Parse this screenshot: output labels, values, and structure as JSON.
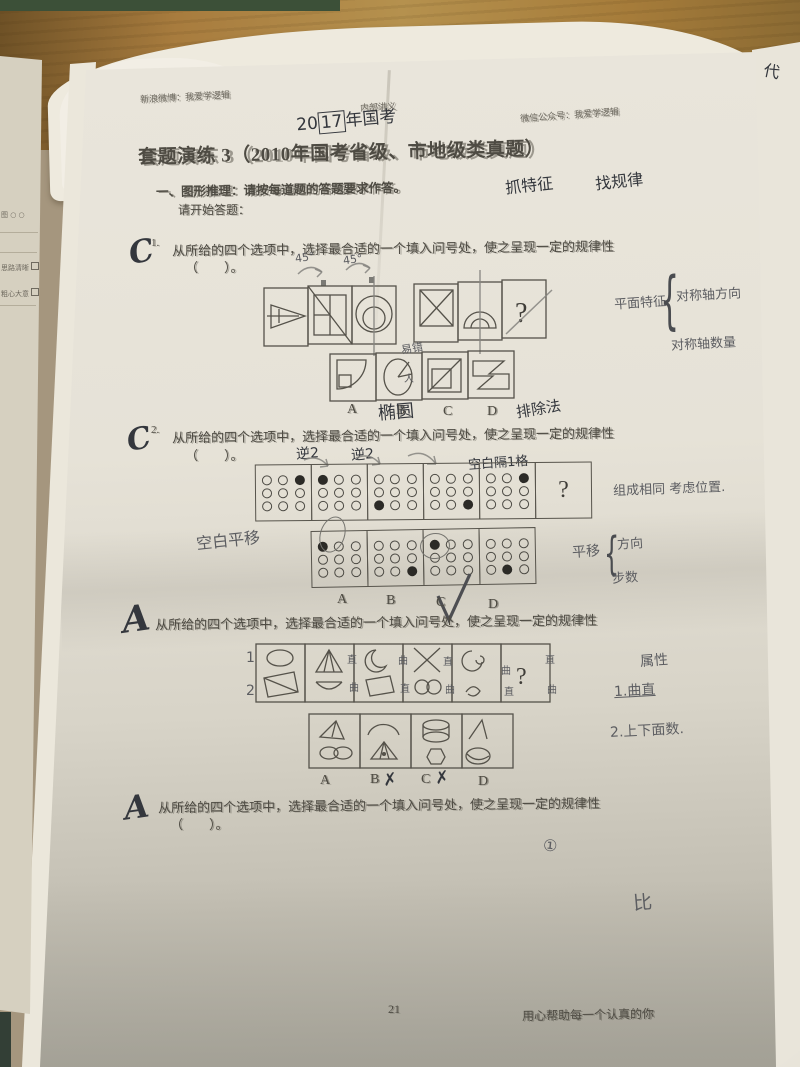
{
  "background": {
    "underlying_print_topright": "…藏的一言一语",
    "underlying_handwriting_topright": "代",
    "left_edge_paper_lines": [
      "图 ○ ○",
      "思路清晰",
      "粗心大意"
    ]
  },
  "header": {
    "watermark_left": "新浪微博：我爱学逻辑",
    "watermark_center": "内部讲义",
    "watermark_right": "微信公众号：我爱学逻辑"
  },
  "title": {
    "printed": "套题演练 3（2010年国考省级、市地级类真题）",
    "handwritten_prefix": "20",
    "handwritten_boxed": "17",
    "handwritten_suffix": "年国考"
  },
  "section": {
    "heading": "一、图形推理：请按每道题的答题要求作答。",
    "start_prompt": "请开始答题：",
    "tip_left": "抓特征",
    "tip_right": "找规律"
  },
  "instruction_text": "从所给的四个选项中，选择最合适的一个填入问号处，使之呈现一定的规律性",
  "brackets": "（　　）。",
  "question_mark": "?",
  "q1": {
    "number": "1.",
    "margin_answer": "C",
    "angle_note_1": "45°",
    "angle_note_2": "45°",
    "note_easy_mistake": "易错",
    "note_person": "人",
    "note_ellipse": "椭圆",
    "note_exclude": "排除法",
    "right_label": "平面特征",
    "brace": "{",
    "right_item_1": "对称轴方向",
    "right_item_2": "对称轴数量",
    "options": [
      "A",
      "B",
      "C",
      "D"
    ]
  },
  "q2": {
    "number": "2.",
    "margin_answer": "C",
    "note_reverse_1": "逆2",
    "note_reverse_2": "逆2",
    "note_blank_gap": "空白隔1格",
    "note_blank_shift": "空白平移",
    "right_note": "组成相同 考虑位置.",
    "right_label": "平移",
    "brace": "{",
    "right_item_1": "方向",
    "right_item_2": "步数",
    "options": [
      "A",
      "B",
      "C",
      "D"
    ],
    "sequence_grids": [
      [
        "o",
        "o",
        "b",
        "o",
        "o",
        "o",
        "o",
        "o",
        "o"
      ],
      [
        "b",
        "o",
        "o",
        "o",
        "o",
        "o",
        "o",
        "o",
        "o"
      ],
      [
        "o",
        "o",
        "o",
        "o",
        "o",
        "o",
        "b",
        "o",
        "o"
      ],
      [
        "o",
        "o",
        "o",
        "o",
        "o",
        "o",
        "o",
        "o",
        "b"
      ],
      [
        "o",
        "o",
        "b",
        "o",
        "o",
        "o",
        "o",
        "o",
        "o"
      ]
    ],
    "option_grids": [
      [
        "b",
        "o",
        "o",
        "o",
        "o",
        "o",
        "o",
        "o",
        "o"
      ],
      [
        "o",
        "o",
        "o",
        "o",
        "o",
        "o",
        "o",
        "o",
        "b"
      ],
      [
        "b",
        "o",
        "o",
        "o",
        "o",
        "o",
        "o",
        "o",
        "o"
      ],
      [
        "o",
        "o",
        "o",
        "o",
        "o",
        "o",
        "o",
        "b",
        "o"
      ]
    ]
  },
  "q3": {
    "margin_answer": "A",
    "row_mark_1": "1",
    "row_mark_2": "2",
    "stroke_marks": [
      {
        "top": "直",
        "bottom": "曲"
      },
      {
        "top": "曲",
        "bottom": "直"
      },
      {
        "top": "直",
        "bottom": "曲"
      },
      {
        "top": "曲",
        "bottom": "直"
      },
      {
        "top": "直",
        "bottom": "曲"
      }
    ],
    "right_title": "属性",
    "right_item_1": "1.曲直",
    "right_item_2": "2.上下面数.",
    "cross_mark": "✗",
    "options": [
      "A",
      "B",
      "C",
      "D"
    ]
  },
  "q4": {
    "margin_answer": "A",
    "mark_circled": "①",
    "mark_scribble": "比"
  },
  "footer": {
    "page_number": "21",
    "slogan": "用心帮助每一个认真的你"
  }
}
